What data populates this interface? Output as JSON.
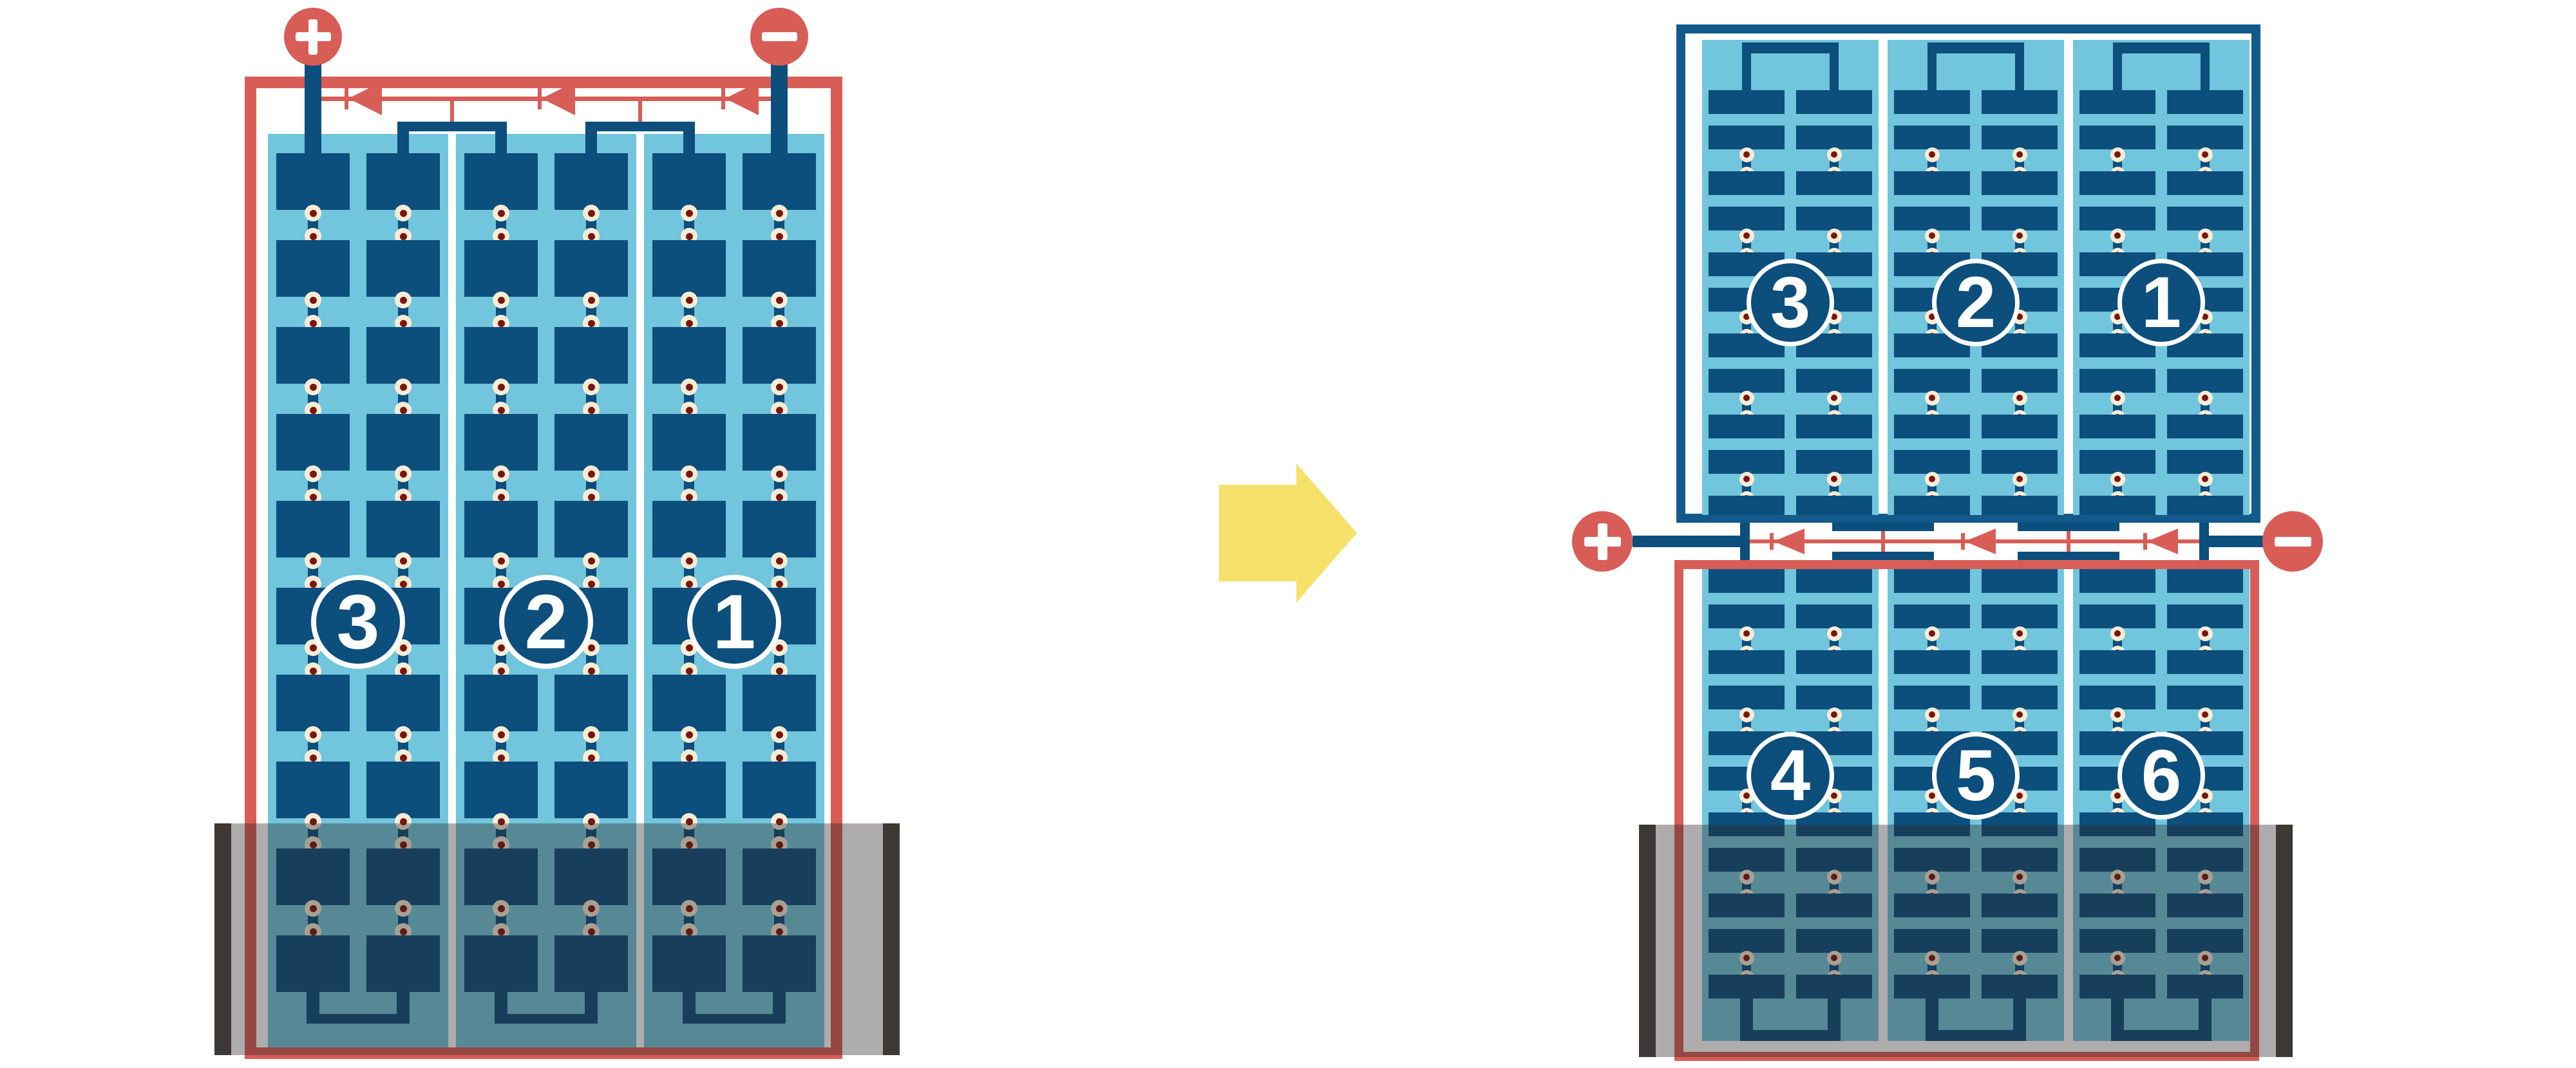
{
  "colors": {
    "red": "#D85D57",
    "frame_blue": "#135A8C",
    "cell_blue": "#0C4E7C",
    "light_blue": "#71C5DC",
    "cream": "#F6EDD7",
    "maroon": "#7C150E",
    "shade": "rgba(42,38,36,0.38)",
    "shade_cap": "#3B3836",
    "arrow_yellow": "#F5E169",
    "white": "#FFFFFF"
  },
  "left_diagram": {
    "terminals": {
      "plus": "+",
      "minus": "−"
    },
    "string_labels": [
      "3",
      "2",
      "1"
    ],
    "bypass_diode_count": 3,
    "shaded_bottom": true
  },
  "arrow": {
    "direction": "right"
  },
  "right_diagram": {
    "terminals": {
      "plus": "+",
      "minus": "−"
    },
    "bypass_diode_count": 3,
    "top_module": {
      "string_labels": [
        "3",
        "2",
        "1"
      ]
    },
    "bottom_module": {
      "string_labels": [
        "4",
        "5",
        "6"
      ],
      "shaded_bottom": true
    }
  }
}
